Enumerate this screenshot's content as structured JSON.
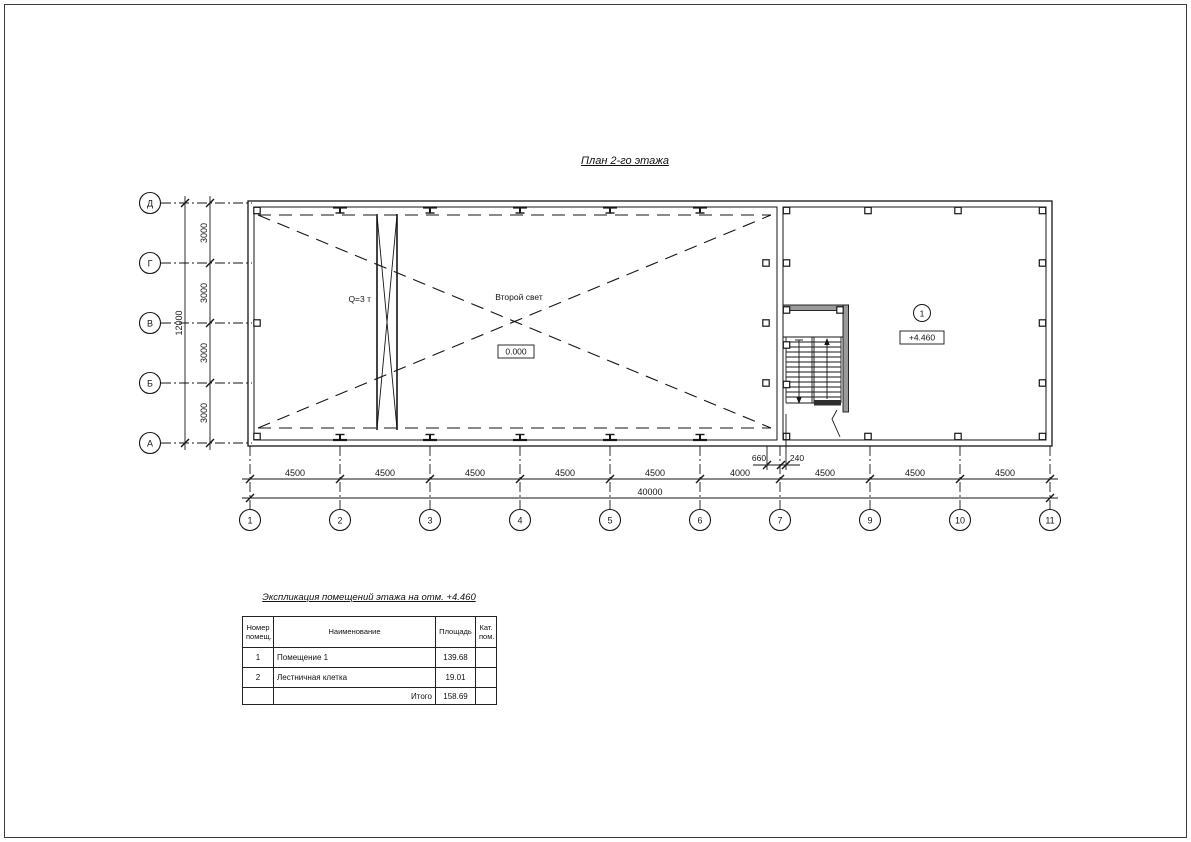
{
  "page": {
    "title": "План 2-го этажа"
  },
  "plan": {
    "crane_label": "Q=3 т",
    "void_label": "Второй свет",
    "elevation_ground": "0.000",
    "room_marker": "1",
    "room_elevation": "+4.460",
    "axes_vertical": [
      "Д",
      "Г",
      "В",
      "Б",
      "А"
    ],
    "axes_horizontal": [
      "1",
      "2",
      "3",
      "4",
      "5",
      "6",
      "7",
      "9",
      "10",
      "11"
    ],
    "dims_left_segments": [
      "3000",
      "3000",
      "3000",
      "3000"
    ],
    "dim_left_total": "12000",
    "dims_bottom_segments": [
      "4500",
      "4500",
      "4500",
      "4500",
      "4500",
      "4000",
      "4500",
      "4500",
      "4500"
    ],
    "dim_bottom_total": "40000",
    "dim_stair_left": "660",
    "dim_stair_right": "240"
  },
  "table": {
    "title": "Экспликация помещений этажа на отм. +4.460",
    "headers": [
      "Номер\nпомещ.",
      "Наименование",
      "Площадь",
      "Кат.\nпом."
    ],
    "rows": [
      {
        "num": "1",
        "name": "Помещение 1",
        "area": "139.68",
        "cat": ""
      },
      {
        "num": "2",
        "name": "Лестничная клетка",
        "area": "19.01",
        "cat": ""
      }
    ],
    "total_label": "Итого",
    "total_value": "158.69"
  }
}
